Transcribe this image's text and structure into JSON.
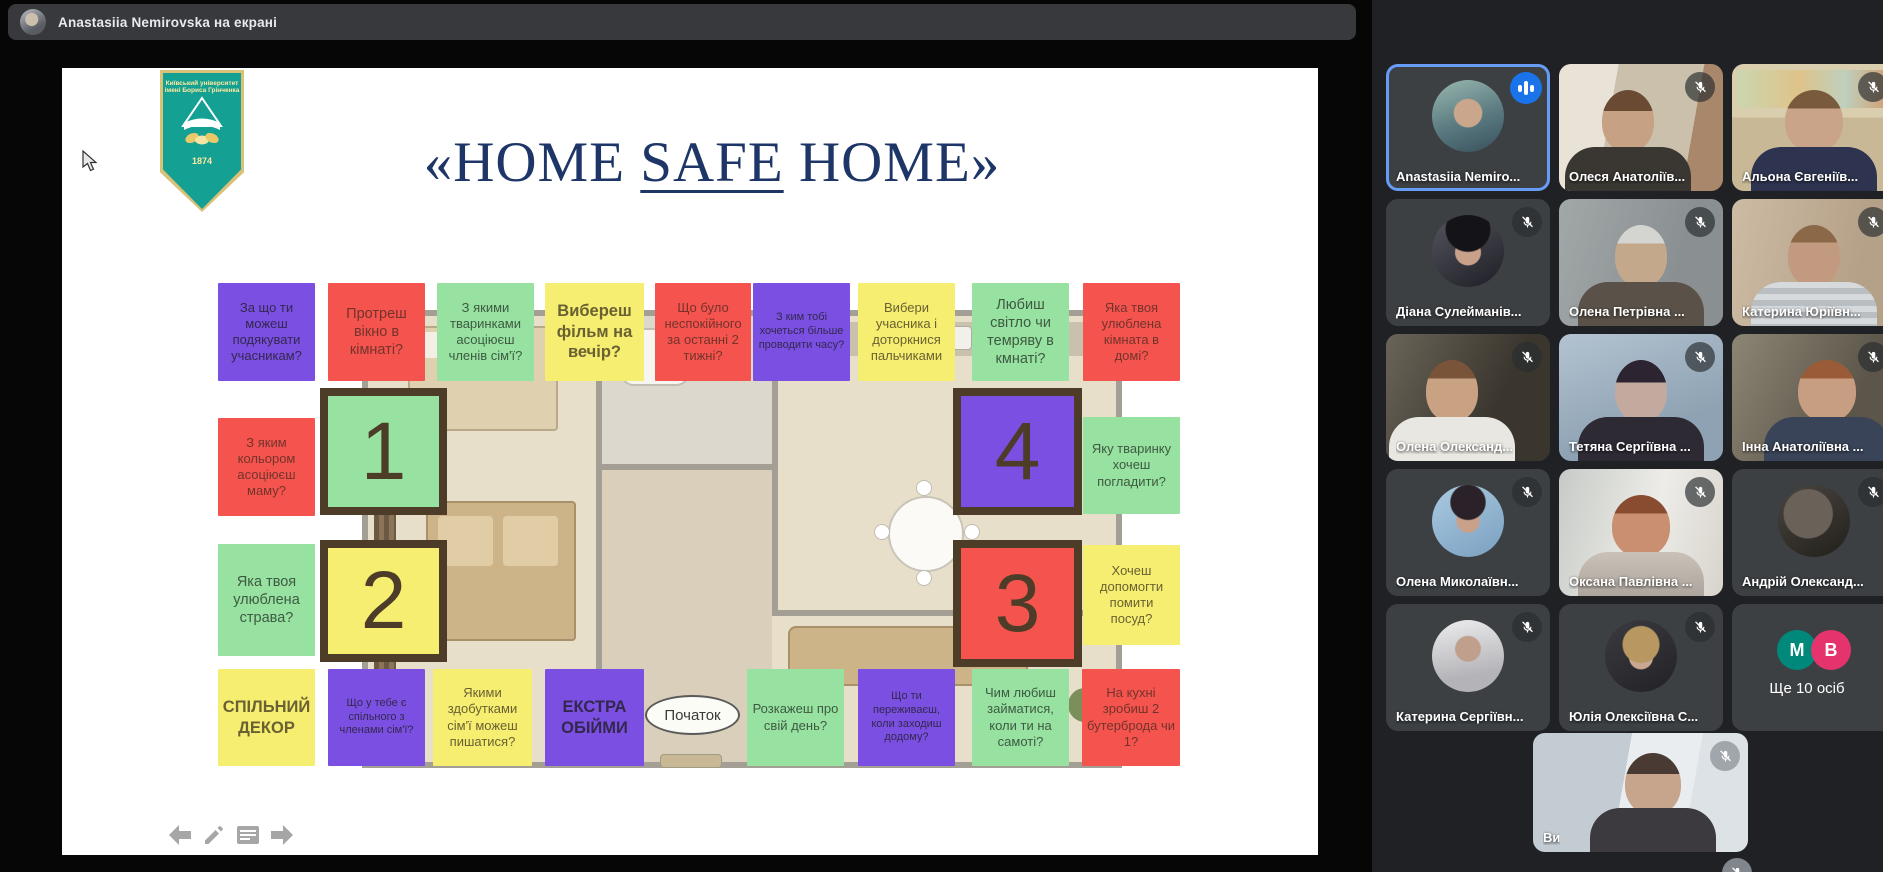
{
  "top_bar": {
    "presenter_label": "Anastasiia Nemirovska на екрані"
  },
  "slide": {
    "title": {
      "pre": "«HOME ",
      "underlined": "SAFE",
      "post": " HOME»"
    },
    "logo": {
      "line1": "Київський університет",
      "line2": "імені Бориса Грінченка",
      "year": "1874"
    },
    "nav_icons": [
      "arrow-left",
      "pencil",
      "notes",
      "arrow-right"
    ],
    "board": {
      "start_label": "Початок",
      "top_row": [
        {
          "text": "За що ти можеш подякувати учасникам?",
          "color": "purple"
        },
        {
          "text": "Протреш вікно в кімнаті?",
          "color": "red"
        },
        {
          "text": "З якими тваринками асоціюєш членів сім'ї?",
          "color": "green"
        },
        {
          "text": "Вибереш фільм на вечір?",
          "color": "yellow"
        },
        {
          "text": "Що було неспокійного за останні 2 тижні?",
          "color": "red"
        },
        {
          "text": "З ким тобі хочеться більше проводити часу?",
          "color": "purple"
        },
        {
          "text": "Вибери учасника і доторкнися пальчиками",
          "color": "yellow"
        },
        {
          "text": "Любиш світло чи темряву в кмнаті?",
          "color": "green"
        },
        {
          "text": "Яка твоя улюблена кімната в домі?",
          "color": "red"
        }
      ],
      "left_column": [
        {
          "text": "З яким кольором асоціюєш маму?",
          "color": "red"
        },
        {
          "text": "Яка твоя улюблена страва?",
          "color": "green"
        }
      ],
      "right_column": [
        {
          "text": "Яку тваринку хочеш погладити?",
          "color": "green"
        },
        {
          "text": "Хочеш допомогти помити посуд?",
          "color": "yellow"
        }
      ],
      "bottom_row": [
        {
          "text": "СПІЛЬНИЙ ДЕКОР",
          "color": "yellow"
        },
        {
          "text": "Що у тебе є спільного з членами сім'ї?",
          "color": "purple"
        },
        {
          "text": "Якими здобутками сім'ї можеш пишатися?",
          "color": "yellow"
        },
        {
          "text": "ЕКСТРА ОБІЙМИ",
          "color": "purple"
        },
        {
          "text": "Розкажеш про свій день?",
          "color": "green"
        },
        {
          "text": "Що ти переживаєш, коли заходиш додому?",
          "color": "purple"
        },
        {
          "text": "Чим любиш займатися, коли ти на самоті?",
          "color": "green"
        },
        {
          "text": "На кухні зробиш 2 бутерброда чи 1?",
          "color": "red"
        }
      ],
      "squares": [
        {
          "num": "1",
          "color": "green"
        },
        {
          "num": "2",
          "color": "yellow"
        },
        {
          "num": "4",
          "color": "purple"
        },
        {
          "num": "3",
          "color": "red"
        }
      ]
    }
  },
  "participants": {
    "tiles": [
      {
        "name": "Anastasiia Nemiro...",
        "kind": "avatar",
        "active": true,
        "speaking": true
      },
      {
        "name": "Олеся Анатоліїв...",
        "kind": "video",
        "muted": true
      },
      {
        "name": "Альона Євгеніїв...",
        "kind": "video",
        "muted": true
      },
      {
        "name": "Діана Сулейманів...",
        "kind": "avatar",
        "muted": true
      },
      {
        "name": "Олена Петрівна ...",
        "kind": "video",
        "muted": true
      },
      {
        "name": "Катерина Юріївн...",
        "kind": "video",
        "muted": true
      },
      {
        "name": "Олена Олександ...",
        "kind": "video",
        "muted": true
      },
      {
        "name": "Тетяна Сергіївна ...",
        "kind": "video",
        "muted": true
      },
      {
        "name": "Інна Анатоліївна ...",
        "kind": "video",
        "muted": true
      },
      {
        "name": "Олена Миколаївн...",
        "kind": "avatar",
        "muted": true
      },
      {
        "name": "Оксана Павлівна ...",
        "kind": "video",
        "muted": true
      },
      {
        "name": "Андрій Олександ...",
        "kind": "avatar",
        "muted": true
      },
      {
        "name": "Катерина Сергіївн...",
        "kind": "avatar",
        "muted": true
      },
      {
        "name": "Юлія Олексіївна С...",
        "kind": "avatar",
        "muted": true
      }
    ],
    "overflow": {
      "label": "Ще 10 осіб",
      "badges": [
        "M",
        "B"
      ]
    },
    "self": {
      "name": "Ви",
      "muted": true
    }
  },
  "colors": {
    "active_border": "#669cf6",
    "speaking_indicator": "#1a73e8",
    "tile_purple": "#7c4fe3",
    "tile_red": "#f4544d",
    "tile_green": "#97e2a1",
    "tile_yellow": "#f6ee71",
    "badge_m": "#00897b",
    "badge_b": "#e5336e",
    "logo_teal": "#14a093",
    "title_navy": "#1e3667"
  }
}
